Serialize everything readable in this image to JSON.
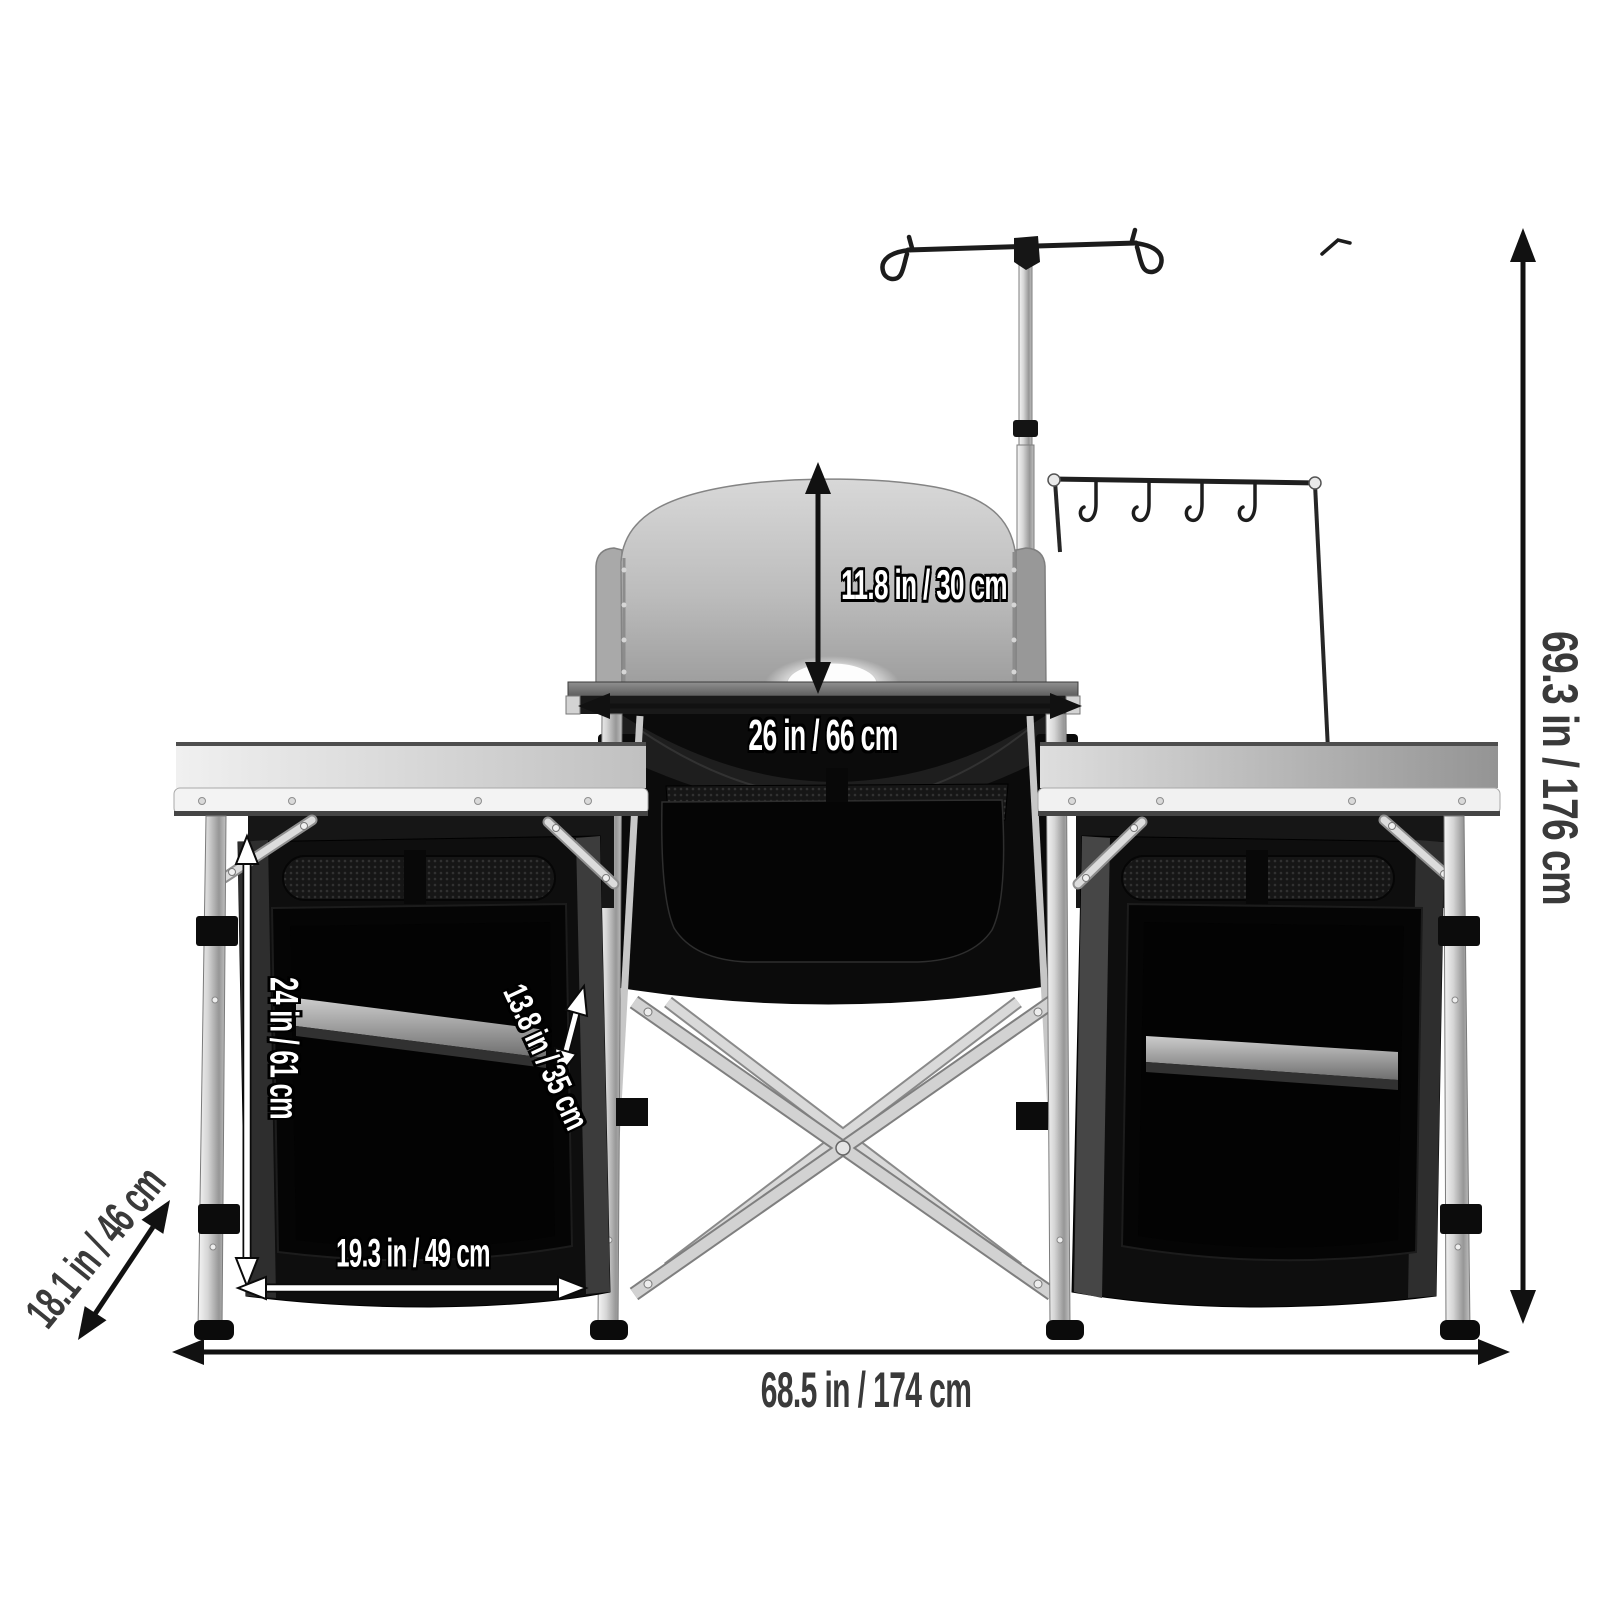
{
  "image_type": "product-dimension-diagram",
  "canvas": {
    "width": 1600,
    "height": 1600,
    "background": "#ffffff"
  },
  "product": {
    "type": "portable-folding-camping-kitchen-table",
    "parts": [
      "lantern-pole",
      "hook-rack",
      "s-hooks",
      "windscreen",
      "center-cook-table",
      "center-storage-compartment",
      "folding-x-frame",
      "left-side-table",
      "right-side-table",
      "left-storage-cabinet-with-shelf",
      "right-storage-cabinet-with-shelf",
      "aluminum-legs"
    ]
  },
  "labels": {
    "windscreen_height": "11.8 in / 30 cm",
    "center_table_width": "26 in / 66 cm",
    "total_height": "69.3 in / 176 cm",
    "total_width": "68.5 in / 174 cm",
    "table_depth": "18.1 in / 46 cm",
    "cabinet_height": "24 in / 61 cm",
    "cabinet_depth": "13.8 in / 35 cm",
    "cabinet_width": "19.3 in / 49 cm"
  },
  "colors": {
    "dimension_line": "#111111",
    "dark_label_text": "#3a3a3a",
    "white_label_text": "#ffffff",
    "label_outline": "#000000",
    "windscreen_gray": "#b5b5b5",
    "fabric_black": "#0d0d0d",
    "aluminum_light": "#d8d8d8",
    "shelf_gray": "#9a9a9a"
  }
}
